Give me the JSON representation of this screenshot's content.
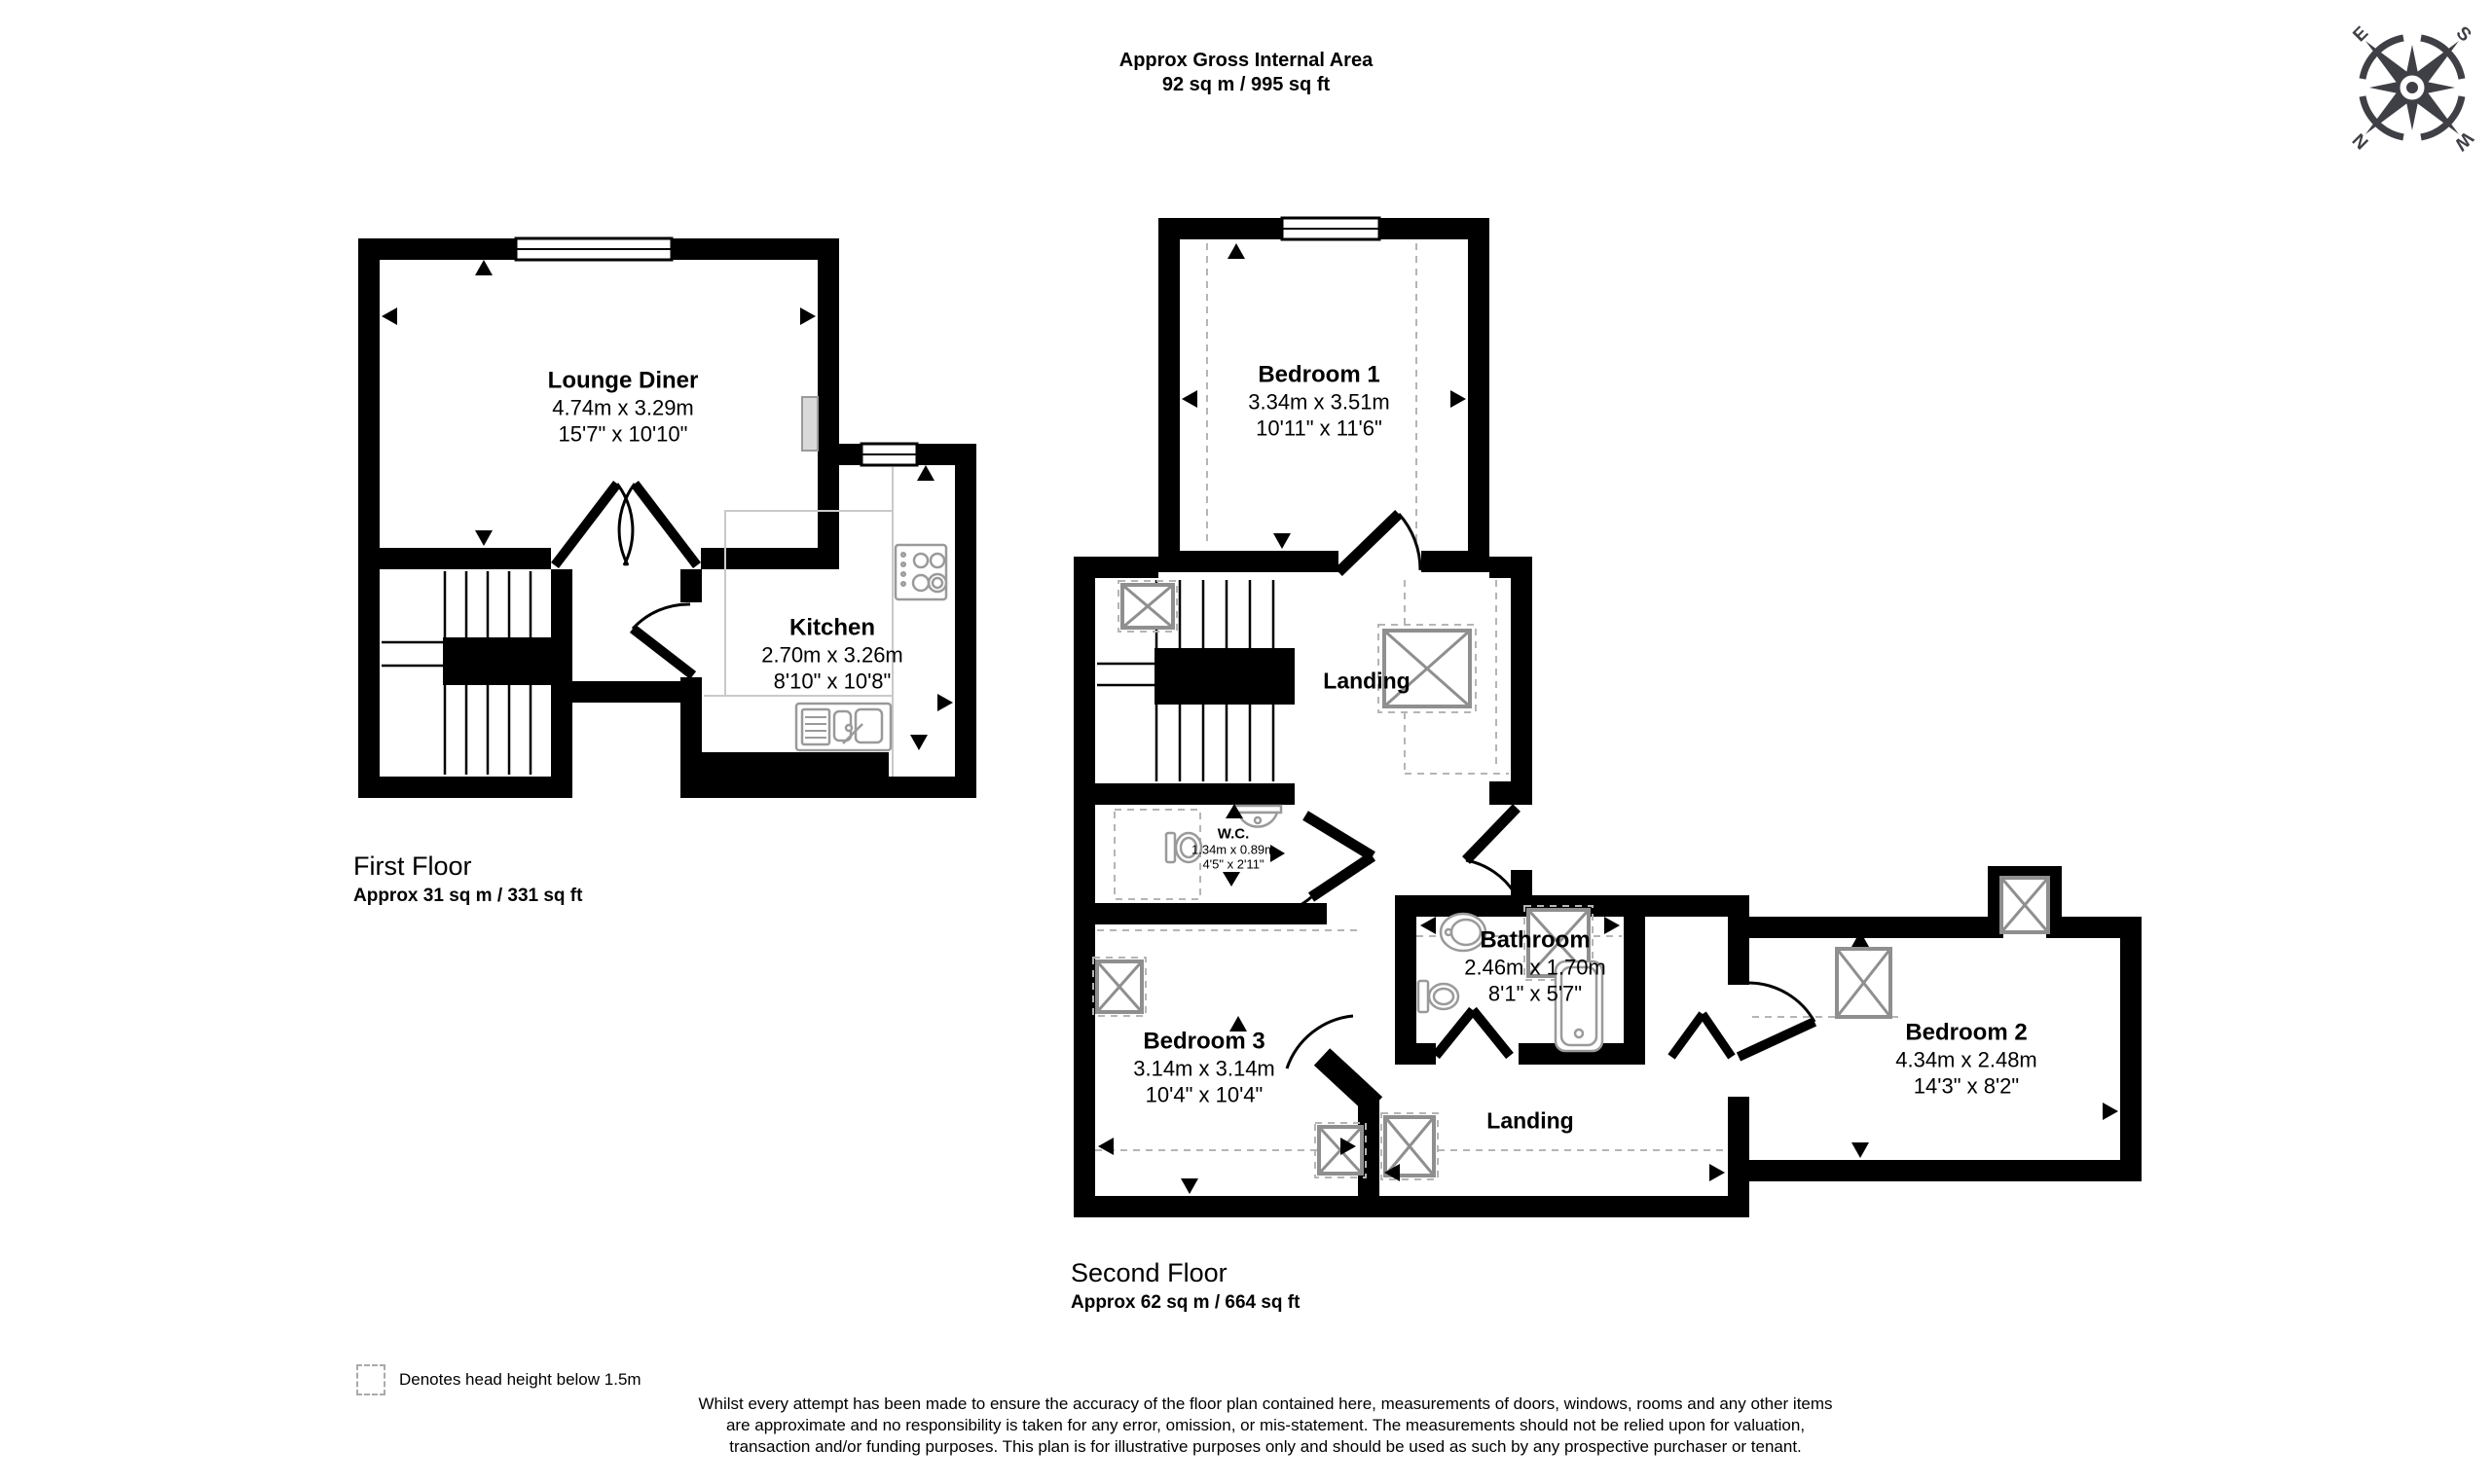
{
  "header": {
    "title_line1": "Approx Gross Internal Area",
    "title_line2": "92 sq m / 995 sq ft"
  },
  "compass": {
    "letters": [
      "E",
      "S",
      "N",
      "W"
    ]
  },
  "floors": [
    {
      "title": "First Floor",
      "area": "Approx 31 sq m / 331 sq ft",
      "rooms": [
        {
          "name": "Lounge Diner",
          "metric": "4.74m x 3.29m",
          "imperial": "15'7\" x 10'10\""
        },
        {
          "name": "Kitchen",
          "metric": "2.70m x 3.26m",
          "imperial": "8'10\" x 10'8\""
        }
      ]
    },
    {
      "title": "Second Floor",
      "area": "Approx 62 sq m / 664 sq ft",
      "rooms": [
        {
          "name": "Bedroom 1",
          "metric": "3.34m x 3.51m",
          "imperial": "10'11\" x 11'6\""
        },
        {
          "name": "Landing"
        },
        {
          "name": "W.C.",
          "metric": "1.34m x 0.89m",
          "imperial": "4'5\" x 2'11\""
        },
        {
          "name": "Bathroom",
          "metric": "2.46m x 1.70m",
          "imperial": "8'1\" x 5'7\""
        },
        {
          "name": "Bedroom 3",
          "metric": "3.14m x 3.14m",
          "imperial": "10'4\" x 10'4\""
        },
        {
          "name": "Landing"
        },
        {
          "name": "Bedroom 2",
          "metric": "4.34m x 2.48m",
          "imperial": "14'3\" x 8'2\""
        }
      ]
    }
  ],
  "legend": {
    "text": "Denotes head height below 1.5m"
  },
  "disclaimer": "Whilst every attempt has been made to ensure the accuracy of the floor plan contained here, measurements of doors, windows, rooms and any other items are approximate and no responsibility is taken for any error, omission, or mis-statement. The measurements should not be relied upon for valuation, transaction and/or funding purposes. This plan is for illustrative purposes only and should be used as such by any prospective purchaser or tenant.",
  "colors": {
    "wall": "#000000",
    "fixture": "#9a9a9a",
    "hatch_box": "#8f8f8f",
    "dashed": "#b5b5b5",
    "compass": "#3f3f46"
  }
}
